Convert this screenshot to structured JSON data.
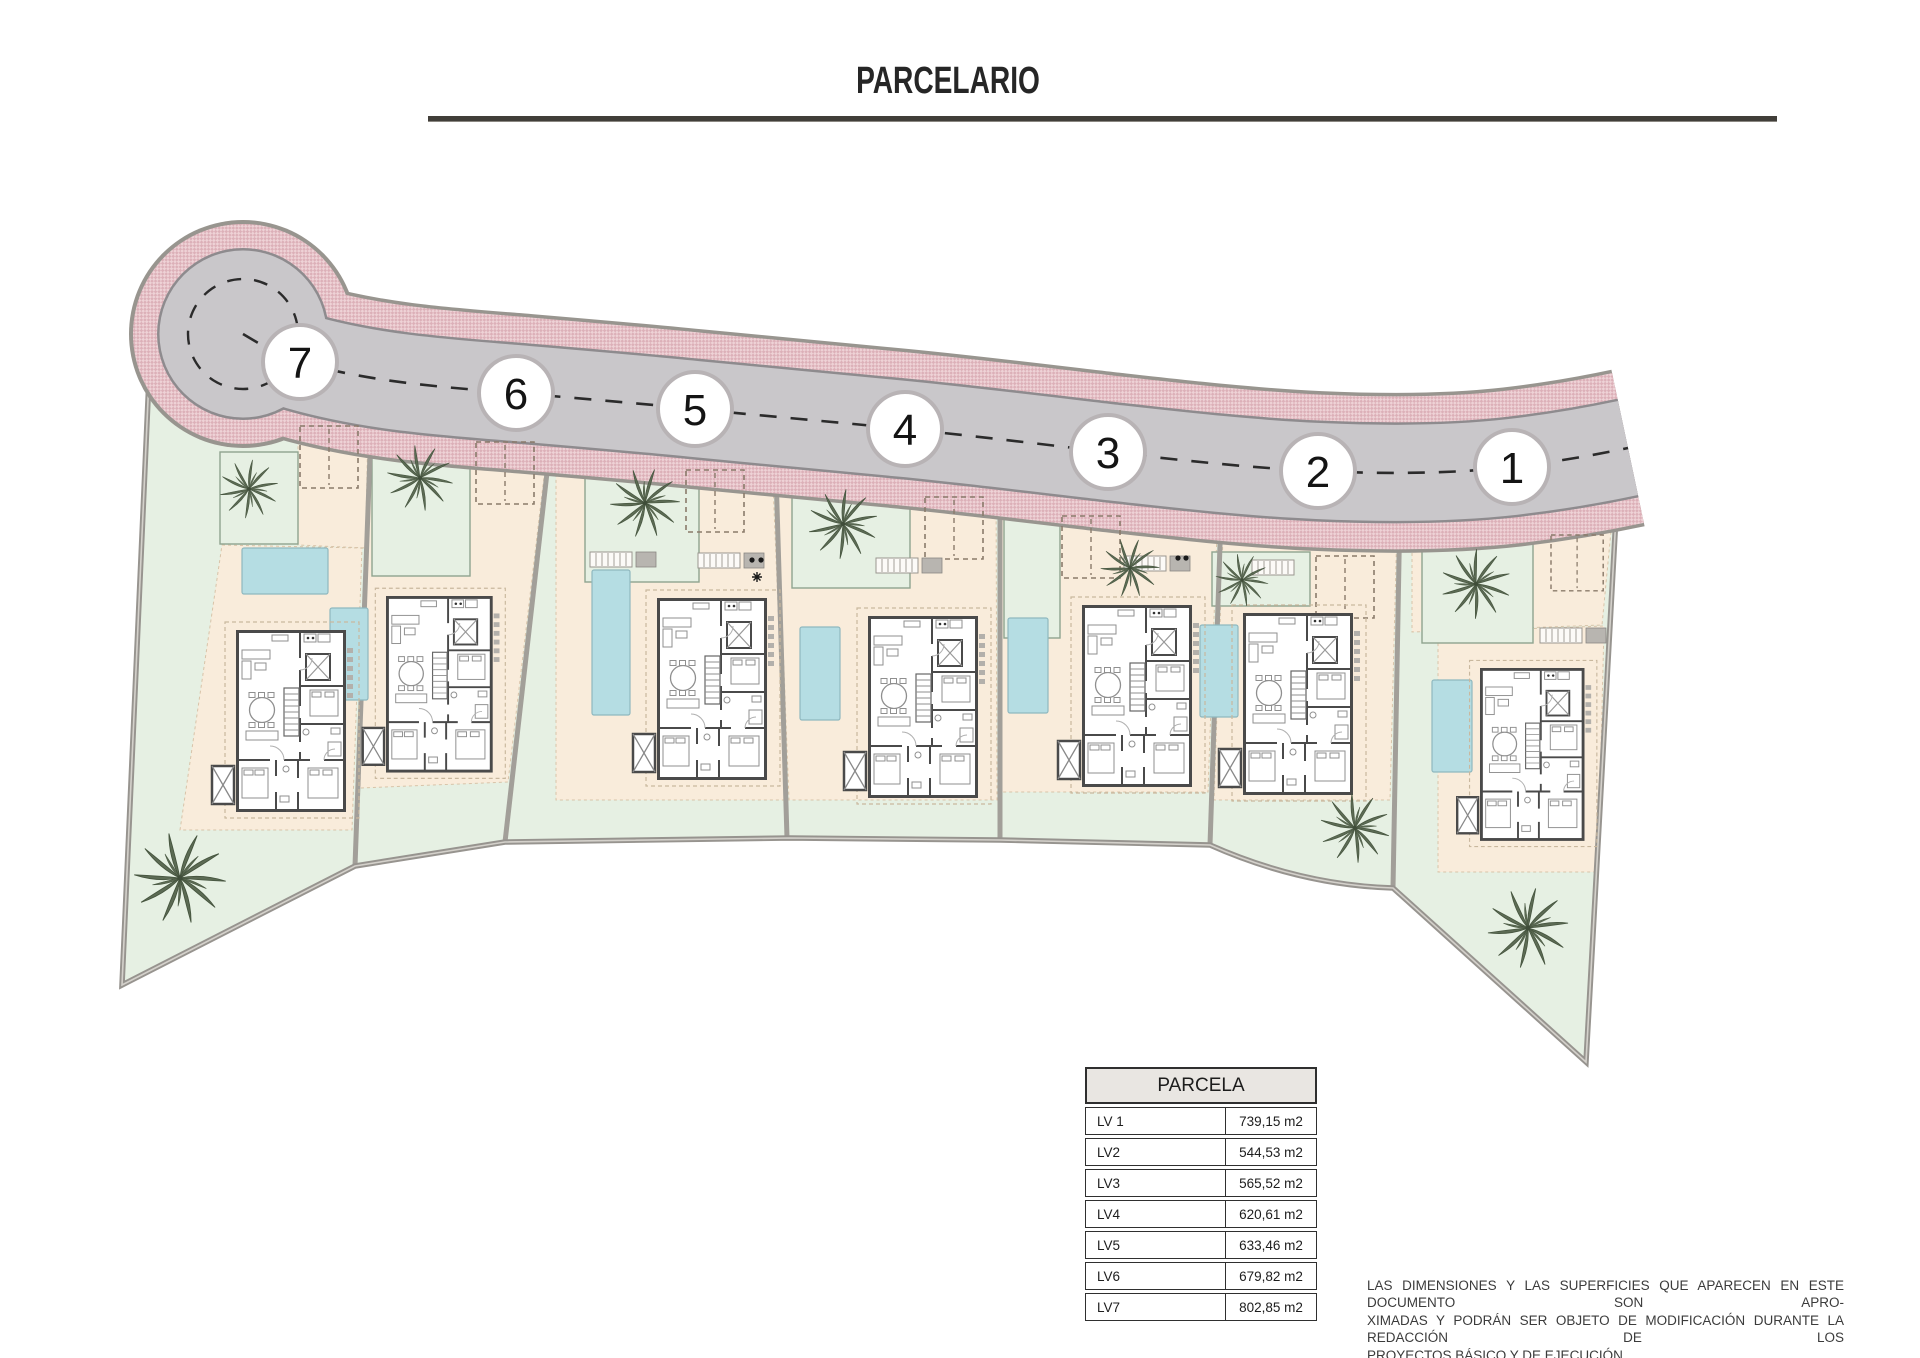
{
  "title": "PARCELARIO",
  "plan": {
    "plot_numbers": [
      "7",
      "6",
      "5",
      "4",
      "3",
      "2",
      "1"
    ]
  },
  "table": {
    "header": "PARCELA",
    "rows": [
      {
        "label": "LV 1",
        "value": "739,15 m2"
      },
      {
        "label": "LV2",
        "value": "544,53 m2"
      },
      {
        "label": "LV3",
        "value": "565,52 m2"
      },
      {
        "label": "LV4",
        "value": "620,61 m2"
      },
      {
        "label": "LV5",
        "value": "633,46 m2"
      },
      {
        "label": "LV6",
        "value": "679,82 m2"
      },
      {
        "label": "LV7",
        "value": "802,85 m2"
      }
    ]
  },
  "disclaimer": {
    "line1": "LAS DIMENSIONES Y LAS SUPERFICIES QUE APARECEN EN ESTE DOCUMENTO SON APRO-",
    "line2": "XIMADAS Y PODRÁN SER OBJETO DE MODIFICACIÓN DURANTE LA REDACCIÓN DE LOS",
    "line3": "PROYECTOS BÁSICO Y DE EJECUCIÓN"
  },
  "colors": {
    "road_gray": "#c9c7ca",
    "sidewalk_pink": "#eed2d6",
    "garden_green": "#e6f0e3",
    "terrace_peach": "#f9ecdb",
    "pool_blue": "#b5dde3"
  }
}
